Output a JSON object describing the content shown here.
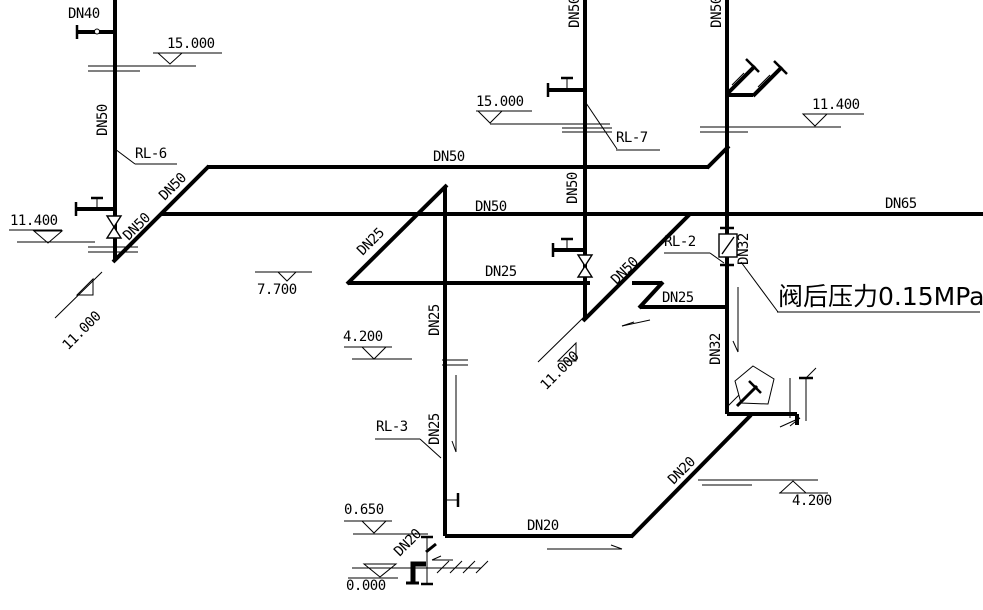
{
  "diagram": {
    "type": "plumbing-riser-diagram",
    "line_color": "#000000",
    "background": "#ffffff",
    "labels": {
      "dn40": "DN40",
      "dn50_left_riser": "DN50",
      "dn50_left_diag_a": "DN50",
      "dn50_left_diag_b": "DN50",
      "dn50_upper_main": "DN50",
      "dn50_main": "DN50",
      "dn65_main": "DN65",
      "dn50_center_riser": "DN50",
      "dn50_center_riser_top": "DN50",
      "dn50_right_riser_top": "DN50",
      "dn50_big_diag": "DN50",
      "dn25_diag": "DN25",
      "dn25_upper": "DN25",
      "dn25_lower": "DN25",
      "dn25_riser_upper": "DN25",
      "dn25_riser_lower": "DN25",
      "dn32_upper": "DN32",
      "dn32_lower": "DN32",
      "dn20_main": "DN20",
      "dn20_diag": "DN20",
      "dn20_ground": "DN20"
    },
    "risers": {
      "rl2": "RL-2",
      "rl3": "RL-3",
      "rl6": "RL-6",
      "rl7": "RL-7"
    },
    "elevations": {
      "e15_left": "15.000",
      "e15_center": "15.000",
      "e11400_left": "11.400",
      "e11400_right": "11.400",
      "e11000_left": "11.000",
      "e11000_right": "11.000",
      "e7700": "7.700",
      "e4200_left": "4.200",
      "e4200_right": "4.200",
      "e0650": "0.650",
      "e0000": "0.000"
    },
    "notes": {
      "valve_pressure": "阀后压力0.15MPa"
    }
  }
}
